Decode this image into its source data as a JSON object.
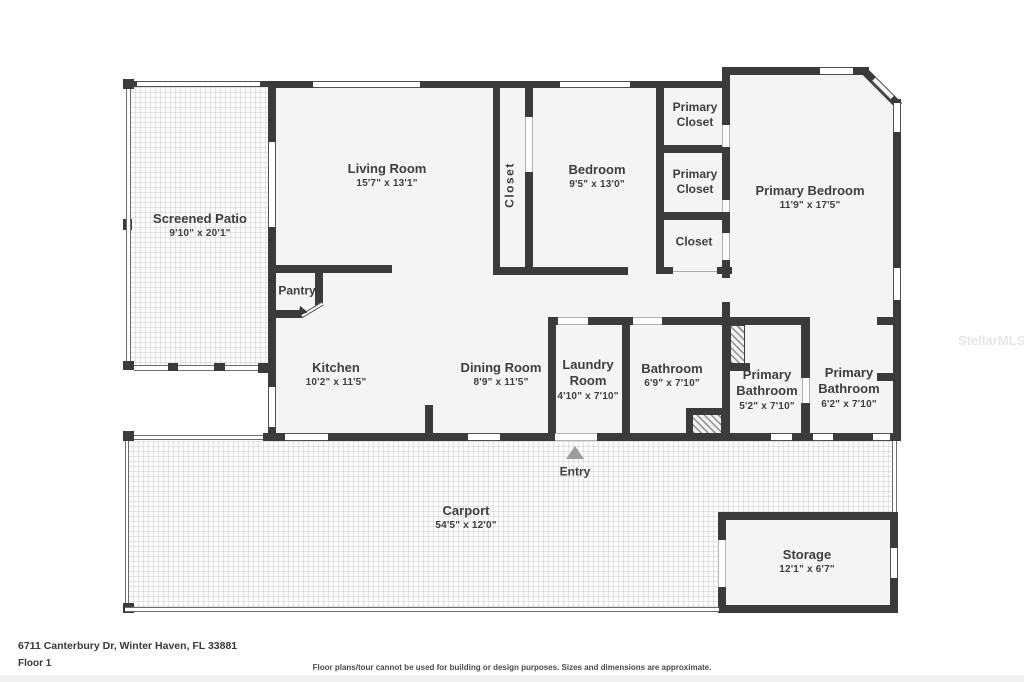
{
  "rooms": [
    {
      "name": "Screened Patio",
      "dims": "9'10\" x 20'1\""
    },
    {
      "name": "Living Room",
      "dims": "15'7\" x 13'1\""
    },
    {
      "name": "Closet"
    },
    {
      "name": "Bedroom",
      "dims": "9'5\" x 13'0\""
    },
    {
      "name": "Primary Closet"
    },
    {
      "name": "Primary Closet"
    },
    {
      "name": "Closet"
    },
    {
      "name": "Primary Bedroom",
      "dims": "11'9\" x 17'5\""
    },
    {
      "name": "Pantry"
    },
    {
      "name": "Kitchen",
      "dims": "10'2\" x 11'5\""
    },
    {
      "name": "Dining Room",
      "dims": "8'9\" x 11'5\""
    },
    {
      "name": "Laundry Room",
      "dims": "4'10\" x 7'10\""
    },
    {
      "name": "Bathroom",
      "dims": "6'9\" x 7'10\""
    },
    {
      "name": "Primary Bathroom",
      "dims": "5'2\" x 7'10\""
    },
    {
      "name": "Primary Bathroom",
      "dims": "6'2\" x 7'10\""
    },
    {
      "name": "Carport",
      "dims": "54'5\" x 12'0\""
    },
    {
      "name": "Storage",
      "dims": "12'1\" x 6'7\""
    },
    {
      "name": "Entry"
    }
  ],
  "watermark": "StellarMLS",
  "footer": {
    "address": "6711 Canterbury Dr, Winter Haven, FL 33881",
    "floor": "Floor 1",
    "disclaimer": "Floor plans/tour cannot be used for building or design purposes. Sizes and dimensions are approximate."
  },
  "colors": {
    "wall": "#3b3b3b",
    "room_fill": "#f4f4f4",
    "entry_arrow": "#9c9c9c",
    "label_text": "#3e3e3e"
  }
}
